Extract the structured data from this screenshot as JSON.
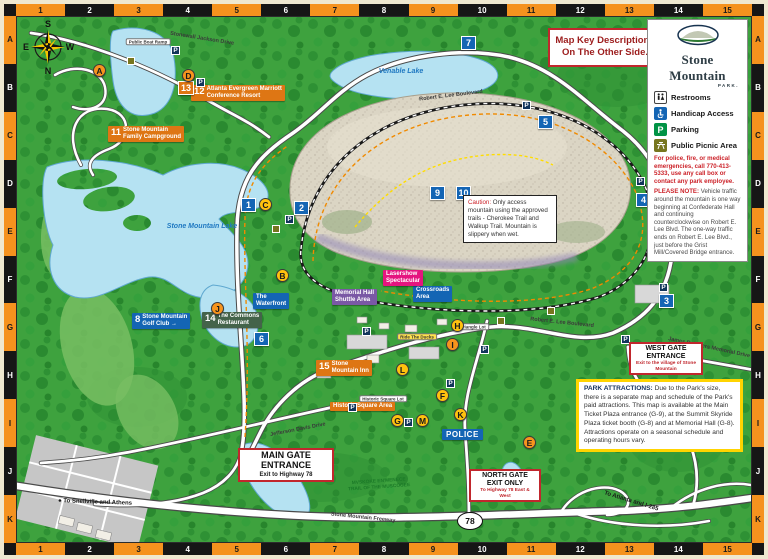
{
  "frame": {
    "cols": [
      "1",
      "2",
      "3",
      "4",
      "5",
      "6",
      "7",
      "8",
      "9",
      "10",
      "11",
      "12",
      "13",
      "14",
      "15"
    ],
    "rows": [
      "A",
      "B",
      "C",
      "D",
      "E",
      "F",
      "G",
      "H",
      "I",
      "J",
      "K"
    ]
  },
  "colors": {
    "band_orange": "#F5921E",
    "band_black": "#161616",
    "label_orange": "#DE7614",
    "label_blue": "#1465B4",
    "label_green": "#44634A",
    "label_pink": "#E5157F",
    "label_purple": "#7A58A5",
    "water": "#B5E2F2",
    "terrain": "#3EA23E",
    "mountain": "#DBD5C4",
    "border_red": "#C1272D",
    "border_yellow": "#FFD400"
  },
  "header": {
    "map_key": "Map Key Descriptions\nOn The Other Side."
  },
  "legend": {
    "brand": {
      "title": "Stone Mountain",
      "sub": "PARK."
    },
    "items": [
      {
        "icon": "restrooms-icon",
        "label": "Restrooms"
      },
      {
        "icon": "handicap-icon",
        "label": "Handicap Access"
      },
      {
        "icon": "parking-icon",
        "label": "Parking"
      },
      {
        "icon": "picnic-icon",
        "label": "Public Picnic Area"
      }
    ],
    "emergency": "For police, fire, or medical emergencies, call 770-413-5333, use any call box or contact any park employee.",
    "note_label": "PLEASE NOTE:",
    "note_text": " Vehicle traffic around the mountain is one way beginning at Confederate Hall and continuing counterclockwise on Robert E. Lee Blvd. The one-way traffic ends on Robert E. Lee Blvd., just before the Grist Mill/Covered Bridge entrance."
  },
  "notes": {
    "caution_label": "Caution:",
    "caution_text": " Only access mountain using the approved trails - Cherokee Trail and Walkup Trail. Mountain is slippery when wet.",
    "attractions_label": "PARK ATTRACTIONS:",
    "attractions_text": " Due to the Park's size, there is a separate map and schedule of the Park's paid attractions. This map is available at the Main Ticket Plaza entrance (G-9), at the Summit Skyride Plaza ticket booth (G-8) and at Memorial Hall (G-8). Attractions operate on a seasonal schedule and operating hours vary."
  },
  "map": {
    "compass": {
      "top": "S",
      "left": "E",
      "right": "W",
      "bottom": "N"
    },
    "highway_shield": "78",
    "gates": [
      {
        "id": "main-gate",
        "lines": "MAIN GATE\nENTRANCE",
        "sub": "Exit to Highway 78",
        "x": 221,
        "y": 431,
        "w": 86,
        "big": true
      },
      {
        "id": "north-gate",
        "lines": "NORTH GATE\nEXIT ONLY",
        "sub": "To Highway 78 East & West",
        "x": 452,
        "y": 452,
        "w": 62,
        "big": false
      },
      {
        "id": "west-gate",
        "lines": "WEST GATE\nENTRANCE",
        "sub": "Exit to the village of Stone Mountain",
        "x": 612,
        "y": 325,
        "w": 64,
        "big": false
      }
    ],
    "place_labels": [
      {
        "s": "orange",
        "num": "11",
        "lines": [
          "Stone Mountain",
          "Family Campground"
        ],
        "x": 91,
        "y": 109
      },
      {
        "s": "orange",
        "num": "12",
        "lines": [
          "Atlanta Evergreen Marriott",
          "Conference Resort"
        ],
        "x": 174,
        "y": 68
      },
      {
        "s": "orange",
        "num": "15",
        "lines": [
          "Stone",
          "Mountain Inn"
        ],
        "x": 299,
        "y": 343
      },
      {
        "s": "orange",
        "num": "",
        "lines": [
          "Historic Square Area"
        ],
        "x": 313,
        "y": 385
      },
      {
        "s": "blue",
        "num": "8",
        "lines": [
          "Stone Mountain",
          "Golf Club →"
        ],
        "x": 115,
        "y": 296
      },
      {
        "s": "blue",
        "num": "",
        "lines": [
          "The",
          "Waterfront"
        ],
        "x": 236,
        "y": 276
      },
      {
        "s": "blue",
        "num": "",
        "lines": [
          "Crossroads",
          "Area"
        ],
        "x": 396,
        "y": 269
      },
      {
        "s": "green",
        "num": "14",
        "lines": [
          "The Commons",
          "Restaurant"
        ],
        "x": 185,
        "y": 295
      },
      {
        "s": "pink",
        "num": "",
        "lines": [
          "Lasershow",
          "Spectacular"
        ],
        "x": 366,
        "y": 253
      },
      {
        "s": "purple",
        "num": "",
        "lines": [
          "Memorial Hall",
          "Shuttle Area"
        ],
        "x": 315,
        "y": 272
      },
      {
        "s": "police",
        "num": "",
        "lines": [
          "POLICE"
        ],
        "x": 425,
        "y": 412
      }
    ],
    "road_labels": [
      {
        "lines": [
          "Stonewall Jackson Drive"
        ],
        "x": 185,
        "y": 22,
        "r": 9,
        "cls": "road"
      },
      {
        "lines": [
          "Robert E. Lee Boulevard"
        ],
        "x": 434,
        "y": 79,
        "r": -7,
        "cls": "road"
      },
      {
        "lines": [
          "Robert E. Lee Boulevard"
        ],
        "x": 545,
        "y": 306,
        "r": 6,
        "cls": "road"
      },
      {
        "lines": [
          "Jefferson Davis Drive"
        ],
        "x": 281,
        "y": 413,
        "r": -11,
        "cls": "road"
      },
      {
        "lines": [
          "James B. Rivers Memorial Drive"
        ],
        "x": 692,
        "y": 331,
        "r": 12,
        "cls": "road"
      },
      {
        "lines": [
          "Stone Mountain Freeway"
        ],
        "x": 346,
        "y": 501,
        "r": 6,
        "cls": "road"
      },
      {
        "lines": [
          "● To Snellville and Athens"
        ],
        "x": 78,
        "y": 486,
        "r": 2,
        "cls": "dest"
      },
      {
        "lines": [
          "To Atlanta and I-285"
        ],
        "x": 614,
        "y": 485,
        "r": 17,
        "cls": "dest"
      },
      {
        "lines": [
          "MVSKOKE EN'MENECE",
          "TRAIL OF THE MUSCOGEE"
        ],
        "x": 362,
        "y": 468,
        "r": -4,
        "cls": "trail"
      },
      {
        "lines": [
          "Venable Lake"
        ],
        "x": 384,
        "y": 55,
        "r": 0,
        "cls": "water"
      },
      {
        "lines": [
          "Stone Mountain Lake"
        ],
        "x": 185,
        "y": 210,
        "r": 0,
        "cls": "water"
      },
      {
        "lines": [
          "Public Boat Ramp"
        ],
        "x": 131,
        "y": 25,
        "r": 0,
        "cls": "pill"
      },
      {
        "lines": [
          "Triangle Lot"
        ],
        "x": 456,
        "y": 310,
        "r": 0,
        "cls": "pill"
      },
      {
        "lines": [
          "Historic Square Lot"
        ],
        "x": 366,
        "y": 382,
        "r": 0,
        "cls": "pill"
      },
      {
        "lines": [
          "Ride The Ducks"
        ],
        "x": 400,
        "y": 320,
        "r": 0,
        "cls": "pill-yellow"
      }
    ],
    "markers": {
      "numbers": [
        {
          "n": "1",
          "x": 224,
          "y": 181
        },
        {
          "n": "2",
          "x": 277,
          "y": 184
        },
        {
          "n": "3",
          "x": 642,
          "y": 277
        },
        {
          "n": "4",
          "x": 619,
          "y": 176
        },
        {
          "n": "5",
          "x": 521,
          "y": 98
        },
        {
          "n": "6",
          "x": 237,
          "y": 315
        },
        {
          "n": "7",
          "x": 444,
          "y": 19
        },
        {
          "n": "9",
          "x": 413,
          "y": 169
        },
        {
          "n": "10",
          "x": 439,
          "y": 169
        }
      ],
      "orange_squares": [
        {
          "n": "13",
          "x": 161,
          "y": 64
        }
      ],
      "letters": [
        {
          "n": "A",
          "x": 76,
          "y": 47,
          "c": "o"
        },
        {
          "n": "B",
          "x": 259,
          "y": 252,
          "c": "y"
        },
        {
          "n": "C",
          "x": 242,
          "y": 181,
          "c": "y"
        },
        {
          "n": "D",
          "x": 165,
          "y": 52,
          "c": "o"
        },
        {
          "n": "E",
          "x": 506,
          "y": 419,
          "c": "o"
        },
        {
          "n": "F",
          "x": 419,
          "y": 372,
          "c": "y"
        },
        {
          "n": "G",
          "x": 374,
          "y": 397,
          "c": "y"
        },
        {
          "n": "H",
          "x": 434,
          "y": 302,
          "c": "y"
        },
        {
          "n": "I",
          "x": 429,
          "y": 321,
          "c": "o"
        },
        {
          "n": "J",
          "x": 194,
          "y": 285,
          "c": "o"
        },
        {
          "n": "K",
          "x": 437,
          "y": 391,
          "c": "y"
        },
        {
          "n": "L",
          "x": 379,
          "y": 346,
          "c": "y"
        },
        {
          "n": "M",
          "x": 399,
          "y": 397,
          "c": "y"
        }
      ],
      "parking_label": "P",
      "parking": [
        {
          "x": 505,
          "y": 84
        },
        {
          "x": 619,
          "y": 160
        },
        {
          "x": 642,
          "y": 266
        },
        {
          "x": 268,
          "y": 198
        },
        {
          "x": 345,
          "y": 310
        },
        {
          "x": 387,
          "y": 401
        },
        {
          "x": 429,
          "y": 362
        },
        {
          "x": 604,
          "y": 318
        },
        {
          "x": 154,
          "y": 29
        },
        {
          "x": 179,
          "y": 61
        },
        {
          "x": 463,
          "y": 328
        },
        {
          "x": 331,
          "y": 386
        }
      ],
      "amenities": [
        {
          "x": 110,
          "y": 40
        },
        {
          "x": 255,
          "y": 208
        },
        {
          "x": 530,
          "y": 290
        },
        {
          "x": 480,
          "y": 300
        }
      ]
    }
  }
}
